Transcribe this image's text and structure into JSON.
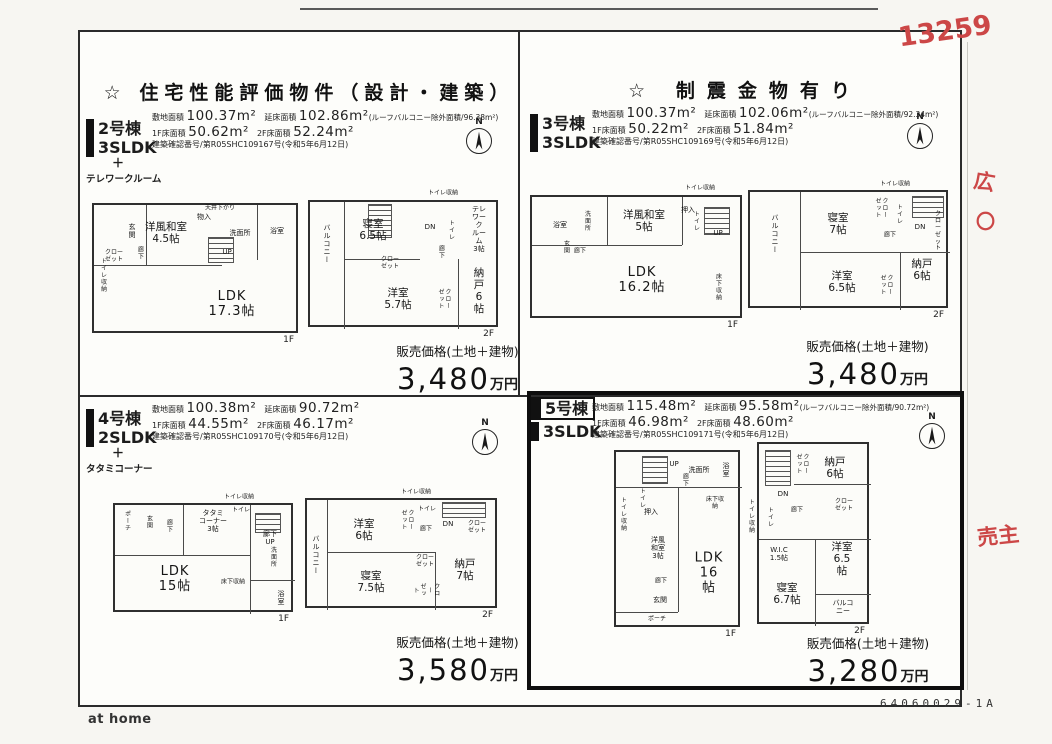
{
  "page": {
    "title_left": "☆ 住宅性能評価物件（設計・建築）",
    "title_right": "☆ 制震金物有り",
    "logo": "at home",
    "code": "64060029-1A",
    "compass_n": "N",
    "price_label": "販売価格(土地＋建物)",
    "price_unit": "万円",
    "handwriting": {
      "number": "13259",
      "mark1": "広",
      "mark2": "〇",
      "mark3": "売主"
    }
  },
  "units": [
    {
      "name": "2号棟",
      "type": "3SLDK",
      "plus": "＋",
      "extra": "テレワークルーム",
      "specs": {
        "site_label": "敷地面積",
        "site": "100.37m²",
        "total_label": "延床面積",
        "total": "102.86m²",
        "total_note": "(ルーフバルコニー除外面積/96.38m²)",
        "f1_label": "1F床面積",
        "f1": "50.62m²",
        "f2_label": "2F床面積",
        "f2": "52.24m²",
        "permit": "建築確認番号/第R05SHC109167号(令和5年6月12日)"
      },
      "price": "3,480",
      "floor1": {
        "label": "1F",
        "rooms": {
          "genkan": "玄関",
          "washitsu": "洋風和室\n4.5帖",
          "mono": "物入",
          "ceiling": "天井下がり",
          "senmen": "洗面所",
          "bath": "浴室",
          "hall": "廊下",
          "closet": "クロー\nゼット",
          "toilet_st": "トイレ収納",
          "up": "UP",
          "ldk": "LDK\n17.3帖"
        }
      },
      "floor2": {
        "label": "2F",
        "rooms": {
          "balcony": "バルコニー",
          "bedroom": "寝室\n6.5帖",
          "toilet_st": "トイレ収納",
          "dn": "DN",
          "toilet": "トイレ",
          "telework": "テレワーク\nルーム\n3帖",
          "hall": "廊下",
          "closet": "クロー\nゼット",
          "yoshitsu": "洋室\n5.7帖",
          "closet2": "クロー\nゼット",
          "nando": "納戸\n6帖"
        }
      }
    },
    {
      "name": "3号棟",
      "type": "3SLDK",
      "specs": {
        "site_label": "敷地面積",
        "site": "100.37m²",
        "total_label": "延床面積",
        "total": "102.06m²",
        "total_note": "(ルーフバルコニー除外面積/92.34m²)",
        "f1_label": "1F床面積",
        "f1": "50.22m²",
        "f2_label": "2F床面積",
        "f2": "51.84m²",
        "permit": "建築確認番号/第R05SHC109169号(令和5年6月12日)"
      },
      "price": "3,480",
      "floor1": {
        "label": "1F",
        "rooms": {
          "bath": "浴室",
          "senmen": "洗面所",
          "washitsu": "洋風和室\n5帖",
          "oshiire": "押入",
          "toilet_st": "トイレ収納",
          "toilet": "トイレ",
          "up": "UP",
          "hall": "廊下",
          "genkan": "玄関",
          "ldk": "LDK\n16.2帖",
          "yukashita": "床下収納"
        }
      },
      "floor2": {
        "label": "2F",
        "rooms": {
          "balcony": "バルコニー",
          "bedroom": "寝室\n7帖",
          "closet": "クロー\nゼット",
          "toilet_st": "トイレ収納",
          "toilet": "トイレ",
          "dn": "DN",
          "closet2": "クロー\nゼット",
          "hall": "廊下",
          "yoshitsu": "洋室\n6.5帖",
          "closet3": "クロー\nゼット",
          "nando": "納戸\n6帖"
        }
      }
    },
    {
      "name": "4号棟",
      "type": "2SLDK",
      "plus": "＋",
      "extra": "タタミコーナー",
      "specs": {
        "site_label": "敷地面積",
        "site": "100.38m²",
        "total_label": "延床面積",
        "total": "90.72m²",
        "total_note": "",
        "f1_label": "1F床面積",
        "f1": "44.55m²",
        "f2_label": "2F床面積",
        "f2": "46.17m²",
        "permit": "建築確認番号/第R05SHC109170号(令和5年6月12日)"
      },
      "price": "3,580",
      "floor1": {
        "label": "1F",
        "rooms": {
          "porch": "ポーチ",
          "genkan": "玄関",
          "hall": "廊下",
          "tatami": "タタミ\nコーナー\n3帖",
          "toilet_st": "トイレ収納",
          "toilet": "トイレ",
          "hall_up": "廊下 UP",
          "senmen": "洗面所",
          "ldk": "LDK\n15帖",
          "yukashita": "床下収納",
          "bath": "浴室"
        }
      },
      "floor2": {
        "label": "2F",
        "rooms": {
          "balcony": "バルコニー",
          "yoshitsu": "洋室\n6帖",
          "closet": "クロー\nゼット",
          "toilet_st": "トイレ収納",
          "toilet": "トイレ",
          "hall": "廊下",
          "dn": "DN",
          "closet2": "クロー\nゼット",
          "bedroom": "寝室\n7.5帖",
          "closet3": "クロー\nゼット",
          "closet4": "クロー\nゼット",
          "nando": "納戸\n7帖"
        }
      }
    },
    {
      "name": "5号棟",
      "type": "3SLDK",
      "specs": {
        "site_label": "敷地面積",
        "site": "115.48m²",
        "total_label": "延床面積",
        "total": "95.58m²",
        "total_note": "(ルーフバルコニー除外面積/90.72m²)",
        "f1_label": "1F床面積",
        "f1": "46.98m²",
        "f2_label": "2F床面積",
        "f2": "48.60m²",
        "permit": "建築確認番号/第R05SHC109171号(令和5年6月12日)"
      },
      "price": "3,280",
      "floor1": {
        "label": "1F",
        "rooms": {
          "up": "UP",
          "hall": "廊下",
          "senmen": "洗面所",
          "bath": "浴室",
          "toilet": "トイレ",
          "toilet_st": "トイレ収納",
          "oshiire": "押入",
          "washitsu": "洋風\n和室\n3帖",
          "hall2": "廊下",
          "genkan": "玄関",
          "porch": "ポーチ",
          "ldk": "LDK\n16帖",
          "yukashita": "床下収納"
        }
      },
      "floor2": {
        "label": "2F",
        "rooms": {
          "closet": "クロー\nゼット",
          "nando": "納戸\n6帖",
          "dn": "DN",
          "toilet": "トイレ",
          "toilet_st": "トイレ収納",
          "hall": "廊下",
          "closet2": "クロー\nゼット",
          "wic": "W.I.C\n1.5帖",
          "yoshitsu": "洋室\n6.5帖",
          "bedroom": "寝室\n6.7帖",
          "balcony": "バルコニー"
        }
      }
    }
  ]
}
